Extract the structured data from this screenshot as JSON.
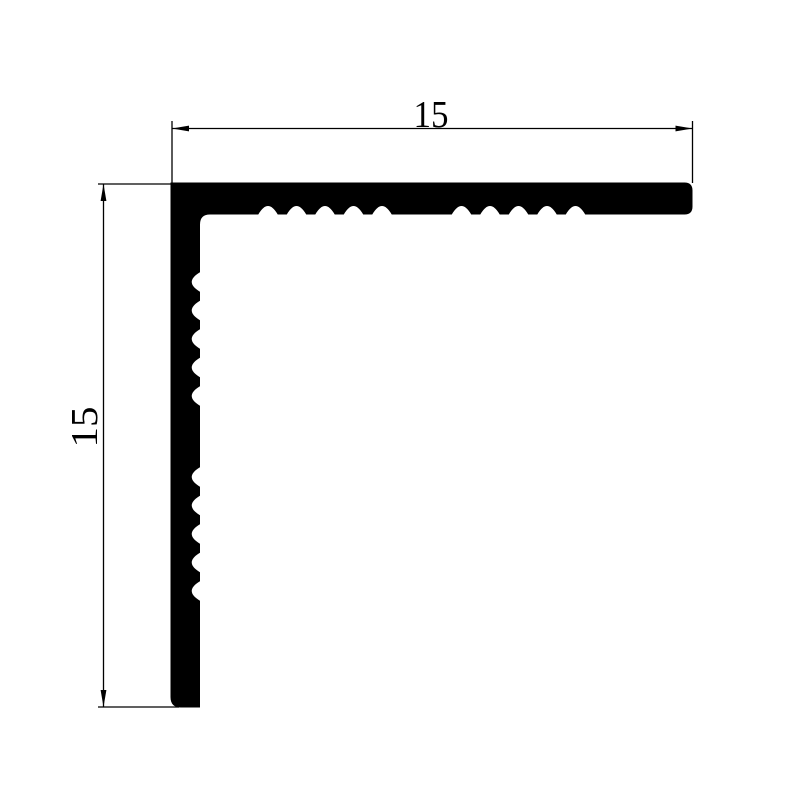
{
  "page": {
    "background_color": "#ffffff",
    "ink_color": "#000000"
  },
  "drawing": {
    "dimensions": {
      "top": {
        "value": "15"
      },
      "left": {
        "value": "15"
      }
    }
  }
}
